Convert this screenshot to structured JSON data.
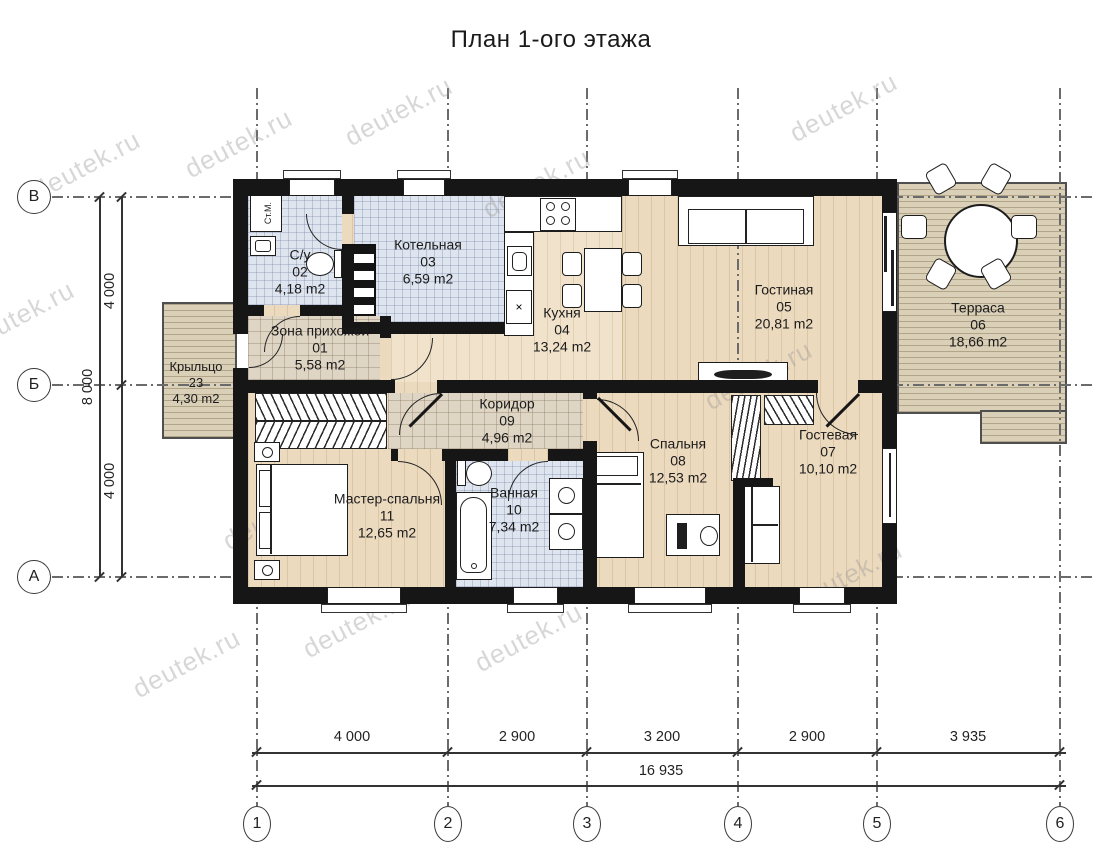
{
  "title": "План 1-ого этажа",
  "watermark": "deutek.ru",
  "axes": {
    "rows": [
      "В",
      "Б",
      "А"
    ],
    "cols": [
      "1",
      "2",
      "3",
      "4",
      "5",
      "6"
    ]
  },
  "dims": {
    "bottom": [
      "4 000",
      "2 900",
      "3 200",
      "2 900",
      "3 935"
    ],
    "bottom_total": "16 935",
    "left": [
      "4 000",
      "4 000"
    ],
    "left_total": "8 000"
  },
  "rooms": {
    "hallway": {
      "name": "Зона прихожей",
      "num": "01",
      "area": "5,58 m2"
    },
    "wc": {
      "name": "С/у",
      "num": "02",
      "area": "4,18 m2"
    },
    "boiler": {
      "name": "Котельная",
      "num": "03",
      "area": "6,59 m2"
    },
    "kitchen": {
      "name": "Кухня",
      "num": "04",
      "area": "13,24 m2"
    },
    "living": {
      "name": "Гостиная",
      "num": "05",
      "area": "20,81 m2"
    },
    "terrace": {
      "name": "Терраса",
      "num": "06",
      "area": "18,66 m2"
    },
    "guest": {
      "name": "Гостевая",
      "num": "07",
      "area": "10,10 m2"
    },
    "bedroom": {
      "name": "Спальня",
      "num": "08",
      "area": "12,53 m2"
    },
    "corridor": {
      "name": "Коридор",
      "num": "09",
      "area": "4,96 m2"
    },
    "bath": {
      "name": "Ванная",
      "num": "10",
      "area": "7,34 m2"
    },
    "master": {
      "name": "Мастер-спальня",
      "num": "11",
      "area": "12,65 m2"
    },
    "porch": {
      "name": "Крыльцо",
      "num": "23",
      "area": "4,30 m2"
    }
  },
  "labels": {
    "washer": "Ст.М."
  }
}
